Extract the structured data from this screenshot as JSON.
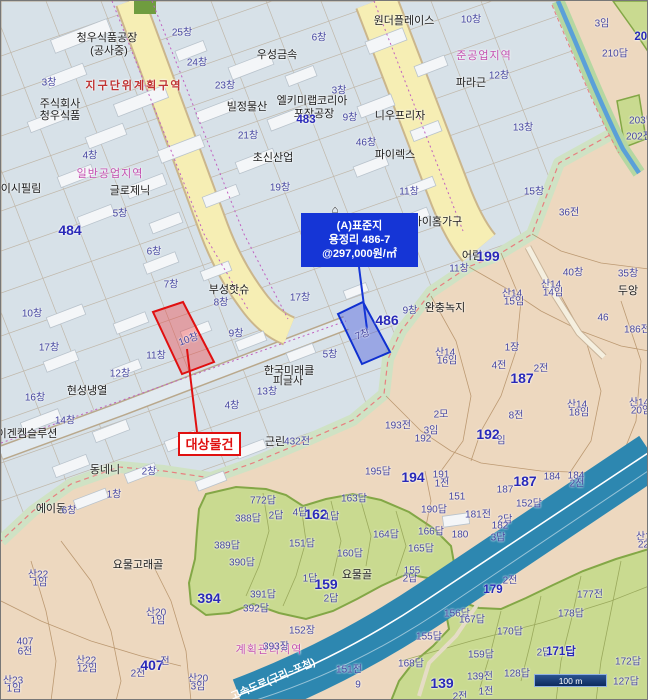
{
  "colors": {
    "industrial_fill": "#d7e1e8",
    "rural_fill": "#edd8bf",
    "paddy_fill": "#c9da90",
    "road_yellow": "#f6eeb4",
    "highway_blue": "#2d87b0",
    "callout_blue": "#1535d6",
    "highlight_red": "#e01010",
    "highlight_blue": "#1030d0"
  },
  "callouts": {
    "standard": {
      "lines": [
        "(A)표준지",
        "용정리 486-7",
        "@297,000원/㎡"
      ]
    },
    "subject": {
      "label": "대상물건"
    }
  },
  "parcel_highlights": {
    "subject_lot_label": "10창",
    "standard_lot_label": "7창"
  },
  "scale_bar": {
    "text": "100 m"
  },
  "labels": [
    {
      "t": "청우식품공장",
      "x": 106,
      "y": 36,
      "c": "nm"
    },
    {
      "t": "(공사중)",
      "x": 108,
      "y": 49,
      "c": "nm"
    },
    {
      "t": "우성금속",
      "x": 276,
      "y": 53,
      "c": "nm"
    },
    {
      "t": "주식회사",
      "x": 59,
      "y": 102,
      "c": "nm"
    },
    {
      "t": "청우식품",
      "x": 59,
      "y": 114,
      "c": "nm"
    },
    {
      "t": "빌정물산",
      "x": 246,
      "y": 105,
      "c": "nm"
    },
    {
      "t": "엘키미랩코리아",
      "x": 311,
      "y": 99,
      "c": "nm"
    },
    {
      "t": "포장공장",
      "x": 313,
      "y": 112,
      "c": "nm"
    },
    {
      "t": "초신산업",
      "x": 272,
      "y": 156,
      "c": "nm"
    },
    {
      "t": "글로제닉",
      "x": 129,
      "y": 189,
      "c": "nm"
    },
    {
      "t": "이시필림",
      "x": 20,
      "y": 187,
      "c": "nm"
    },
    {
      "t": "원더플레이스",
      "x": 403,
      "y": 19,
      "c": "nm"
    },
    {
      "t": "니우프리자",
      "x": 399,
      "y": 114,
      "c": "nm"
    },
    {
      "t": "파이렉스",
      "x": 394,
      "y": 153,
      "c": "nm"
    },
    {
      "t": "파라근",
      "x": 470,
      "y": 81,
      "c": "nm"
    },
    {
      "t": "부성핫슈",
      "x": 228,
      "y": 288,
      "c": "nm"
    },
    {
      "t": "현성냉열",
      "x": 86,
      "y": 389,
      "c": "nm"
    },
    {
      "t": "한국미래클",
      "x": 288,
      "y": 369,
      "c": "nm"
    },
    {
      "t": "피글사",
      "x": 287,
      "y": 379,
      "c": "nm"
    },
    {
      "t": "이겐켐슬루션",
      "x": 26,
      "y": 432,
      "c": "nm"
    },
    {
      "t": "동네니",
      "x": 104,
      "y": 468,
      "c": "nm"
    },
    {
      "t": "에이동",
      "x": 50,
      "y": 507,
      "c": "nm"
    },
    {
      "t": "아이홈가구",
      "x": 436,
      "y": 220,
      "c": "nm"
    },
    {
      "t": "⌂",
      "x": 334,
      "y": 209,
      "c": "nm"
    },
    {
      "t": "어림",
      "x": 471,
      "y": 254,
      "c": "nm"
    },
    {
      "t": "완충녹지",
      "x": 444,
      "y": 306,
      "c": "nm"
    },
    {
      "t": "요물고래골",
      "x": 137,
      "y": 563,
      "c": "nm"
    },
    {
      "t": "요물골",
      "x": 356,
      "y": 573,
      "c": "nm"
    },
    {
      "t": "두앙",
      "x": 627,
      "y": 289,
      "c": "nm"
    },
    {
      "t": "근린",
      "x": 274,
      "y": 440,
      "c": "nm"
    },
    {
      "t": "지구단위계획구역",
      "x": 133,
      "y": 84,
      "c": "red"
    },
    {
      "t": "일반공업지역",
      "x": 109,
      "y": 172,
      "c": "pink"
    },
    {
      "t": "준공업지역",
      "x": 483,
      "y": 54,
      "c": "pink"
    },
    {
      "t": "계획관리지역",
      "x": 268,
      "y": 648,
      "c": "pink"
    },
    {
      "t": "25창",
      "x": 181,
      "y": 30
    },
    {
      "t": "6창",
      "x": 318,
      "y": 35
    },
    {
      "t": "24창",
      "x": 196,
      "y": 60
    },
    {
      "t": "3창",
      "x": 48,
      "y": 80
    },
    {
      "t": "23창",
      "x": 224,
      "y": 83
    },
    {
      "t": "3창",
      "x": 338,
      "y": 88
    },
    {
      "t": "10창",
      "x": 470,
      "y": 17
    },
    {
      "t": "12창",
      "x": 498,
      "y": 73
    },
    {
      "t": "9창",
      "x": 349,
      "y": 115
    },
    {
      "t": "13창",
      "x": 522,
      "y": 125
    },
    {
      "t": "21창",
      "x": 247,
      "y": 133
    },
    {
      "t": "46창",
      "x": 365,
      "y": 140
    },
    {
      "t": "4창",
      "x": 89,
      "y": 153
    },
    {
      "t": "19창",
      "x": 279,
      "y": 185
    },
    {
      "t": "11창",
      "x": 408,
      "y": 189
    },
    {
      "t": "15창",
      "x": 533,
      "y": 189
    },
    {
      "t": "5창",
      "x": 119,
      "y": 211
    },
    {
      "t": "36전",
      "x": 568,
      "y": 210
    },
    {
      "t": "3임",
      "x": 601,
      "y": 21
    },
    {
      "t": "208",
      "x": 643,
      "y": 36,
      "c": "med"
    },
    {
      "t": "210답",
      "x": 614,
      "y": 51
    },
    {
      "t": "203답",
      "x": 641,
      "y": 118
    },
    {
      "t": "202전",
      "x": 638,
      "y": 134
    },
    {
      "t": "483",
      "x": 305,
      "y": 119,
      "c": "med"
    },
    {
      "t": "484",
      "x": 69,
      "y": 229,
      "c": "big"
    },
    {
      "t": "6창",
      "x": 153,
      "y": 249
    },
    {
      "t": "7창",
      "x": 170,
      "y": 282
    },
    {
      "t": "8창",
      "x": 220,
      "y": 300
    },
    {
      "t": "17창",
      "x": 299,
      "y": 295
    },
    {
      "t": "10창",
      "x": 31,
      "y": 311
    },
    {
      "t": "9창",
      "x": 235,
      "y": 331
    },
    {
      "t": "17창",
      "x": 48,
      "y": 345
    },
    {
      "t": "11창",
      "x": 155,
      "y": 353
    },
    {
      "t": "12창",
      "x": 119,
      "y": 371
    },
    {
      "t": "16창",
      "x": 34,
      "y": 395
    },
    {
      "t": "13창",
      "x": 266,
      "y": 389
    },
    {
      "t": "4창",
      "x": 231,
      "y": 403
    },
    {
      "t": "14창",
      "x": 64,
      "y": 418
    },
    {
      "t": "2창",
      "x": 148,
      "y": 469
    },
    {
      "t": "1창",
      "x": 113,
      "y": 492
    },
    {
      "t": "6창",
      "x": 68,
      "y": 508
    },
    {
      "t": "10창",
      "x": 187,
      "y": 337,
      "r": -20
    },
    {
      "t": "7창",
      "x": 361,
      "y": 332,
      "r": -20
    },
    {
      "t": "11창",
      "x": 458,
      "y": 266
    },
    {
      "t": "9창",
      "x": 409,
      "y": 308
    },
    {
      "t": "5창",
      "x": 329,
      "y": 352
    },
    {
      "t": "486",
      "x": 386,
      "y": 319,
      "c": "big"
    },
    {
      "t": "1장",
      "x": 511,
      "y": 345
    },
    {
      "t": "4전",
      "x": 498,
      "y": 363
    },
    {
      "t": "2전",
      "x": 540,
      "y": 366
    },
    {
      "t": "187",
      "x": 521,
      "y": 377,
      "c": "big"
    },
    {
      "t": "199",
      "x": 487,
      "y": 255,
      "c": "big"
    },
    {
      "t": "40창",
      "x": 572,
      "y": 270
    },
    {
      "t": "35창",
      "x": 627,
      "y": 271
    },
    {
      "t": "46",
      "x": 602,
      "y": 317
    },
    {
      "t": "186전",
      "x": 636,
      "y": 327
    },
    {
      "t": "산14",
      "x": 550,
      "y": 282
    },
    {
      "t": "14임",
      "x": 552,
      "y": 290
    },
    {
      "t": "산14",
      "x": 511,
      "y": 291
    },
    {
      "t": "15임",
      "x": 513,
      "y": 299
    },
    {
      "t": "산14",
      "x": 444,
      "y": 350
    },
    {
      "t": "16임",
      "x": 446,
      "y": 358
    },
    {
      "t": "산14",
      "x": 576,
      "y": 402
    },
    {
      "t": "18임",
      "x": 578,
      "y": 410
    },
    {
      "t": "산14",
      "x": 638,
      "y": 400
    },
    {
      "t": "20임",
      "x": 640,
      "y": 408
    },
    {
      "t": "산14",
      "x": 645,
      "y": 534
    },
    {
      "t": "22임",
      "x": 647,
      "y": 542
    },
    {
      "t": "2모",
      "x": 440,
      "y": 412
    },
    {
      "t": "8전",
      "x": 515,
      "y": 413
    },
    {
      "t": "3임",
      "x": 430,
      "y": 428
    },
    {
      "t": "193전",
      "x": 397,
      "y": 423
    },
    {
      "t": "192",
      "x": 422,
      "y": 438
    },
    {
      "t": "192",
      "x": 487,
      "y": 433,
      "c": "big"
    },
    {
      "t": "임",
      "x": 500,
      "y": 438
    },
    {
      "t": "432전",
      "x": 296,
      "y": 439
    },
    {
      "t": "772답",
      "x": 262,
      "y": 498
    },
    {
      "t": "388답",
      "x": 247,
      "y": 516
    },
    {
      "t": "2답",
      "x": 275,
      "y": 513
    },
    {
      "t": "4답",
      "x": 299,
      "y": 510
    },
    {
      "t": "162",
      "x": 315,
      "y": 513,
      "c": "big"
    },
    {
      "t": "1답",
      "x": 331,
      "y": 514
    },
    {
      "t": "389답",
      "x": 226,
      "y": 543
    },
    {
      "t": "151답",
      "x": 301,
      "y": 541
    },
    {
      "t": "390답",
      "x": 241,
      "y": 560
    },
    {
      "t": "1답",
      "x": 309,
      "y": 576
    },
    {
      "t": "394",
      "x": 208,
      "y": 597,
      "c": "big"
    },
    {
      "t": "391답",
      "x": 262,
      "y": 592
    },
    {
      "t": "392답",
      "x": 255,
      "y": 606
    },
    {
      "t": "159",
      "x": 325,
      "y": 583,
      "c": "big"
    },
    {
      "t": "2답",
      "x": 330,
      "y": 596
    },
    {
      "t": "163답",
      "x": 353,
      "y": 496
    },
    {
      "t": "164답",
      "x": 385,
      "y": 532
    },
    {
      "t": "166답",
      "x": 430,
      "y": 529
    },
    {
      "t": "165답",
      "x": 420,
      "y": 546
    },
    {
      "t": "160답",
      "x": 349,
      "y": 551
    },
    {
      "t": "155",
      "x": 411,
      "y": 570
    },
    {
      "t": "2답",
      "x": 409,
      "y": 576
    },
    {
      "t": "195답",
      "x": 377,
      "y": 469
    },
    {
      "t": "191",
      "x": 440,
      "y": 474
    },
    {
      "t": "1전",
      "x": 441,
      "y": 481
    },
    {
      "t": "194",
      "x": 412,
      "y": 476,
      "c": "big"
    },
    {
      "t": "187",
      "x": 524,
      "y": 480,
      "c": "big"
    },
    {
      "t": "187",
      "x": 504,
      "y": 489
    },
    {
      "t": "184",
      "x": 551,
      "y": 476
    },
    {
      "t": "184",
      "x": 575,
      "y": 475
    },
    {
      "t": "2전",
      "x": 576,
      "y": 481
    },
    {
      "t": "151",
      "x": 456,
      "y": 496
    },
    {
      "t": "152답",
      "x": 528,
      "y": 501
    },
    {
      "t": "190답",
      "x": 433,
      "y": 507
    },
    {
      "t": "181전",
      "x": 477,
      "y": 512
    },
    {
      "t": "180",
      "x": 459,
      "y": 534
    },
    {
      "t": "2답",
      "x": 504,
      "y": 517
    },
    {
      "t": "182",
      "x": 499,
      "y": 525
    },
    {
      "t": "3답",
      "x": 497,
      "y": 535
    },
    {
      "t": "2전",
      "x": 509,
      "y": 578
    },
    {
      "t": "179",
      "x": 492,
      "y": 589,
      "c": "med"
    },
    {
      "t": "177전",
      "x": 589,
      "y": 592
    },
    {
      "t": "156답",
      "x": 456,
      "y": 611
    },
    {
      "t": "167답",
      "x": 471,
      "y": 617
    },
    {
      "t": "178답",
      "x": 570,
      "y": 611
    },
    {
      "t": "155답",
      "x": 428,
      "y": 634
    },
    {
      "t": "170답",
      "x": 509,
      "y": 629
    },
    {
      "t": "2답",
      "x": 543,
      "y": 650
    },
    {
      "t": "171답",
      "x": 560,
      "y": 650,
      "c": "med"
    },
    {
      "t": "159답",
      "x": 480,
      "y": 652
    },
    {
      "t": "168답",
      "x": 410,
      "y": 661
    },
    {
      "t": "139전",
      "x": 479,
      "y": 674
    },
    {
      "t": "128답",
      "x": 516,
      "y": 671
    },
    {
      "t": "172답",
      "x": 627,
      "y": 659
    },
    {
      "t": "127답",
      "x": 625,
      "y": 679
    },
    {
      "t": "151전",
      "x": 348,
      "y": 667
    },
    {
      "t": "9",
      "x": 357,
      "y": 684
    },
    {
      "t": "1전",
      "x": 485,
      "y": 689
    },
    {
      "t": "2전",
      "x": 459,
      "y": 694
    },
    {
      "t": "139",
      "x": 441,
      "y": 682,
      "c": "big"
    },
    {
      "t": "152장",
      "x": 301,
      "y": 628
    },
    {
      "t": "393장",
      "x": 275,
      "y": 644
    },
    {
      "t": "2전",
      "x": 137,
      "y": 671
    },
    {
      "t": "407",
      "x": 151,
      "y": 664,
      "c": "big"
    },
    {
      "t": "전",
      "x": 164,
      "y": 659
    },
    {
      "t": "산22",
      "x": 37,
      "y": 572
    },
    {
      "t": "1임",
      "x": 39,
      "y": 580
    },
    {
      "t": "407",
      "x": 24,
      "y": 641
    },
    {
      "t": "6전",
      "x": 24,
      "y": 649
    },
    {
      "t": "산22",
      "x": 85,
      "y": 658
    },
    {
      "t": "12임",
      "x": 86,
      "y": 666
    },
    {
      "t": "산23",
      "x": 12,
      "y": 678
    },
    {
      "t": "1임",
      "x": 13,
      "y": 686
    },
    {
      "t": "산20",
      "x": 155,
      "y": 610
    },
    {
      "t": "1임",
      "x": 157,
      "y": 618
    },
    {
      "t": "산20",
      "x": 197,
      "y": 676
    },
    {
      "t": "3임",
      "x": 197,
      "y": 684
    },
    {
      "t": "고속도로(구리~포천)",
      "x": 272,
      "y": 678,
      "c": "road",
      "r": -23
    }
  ]
}
